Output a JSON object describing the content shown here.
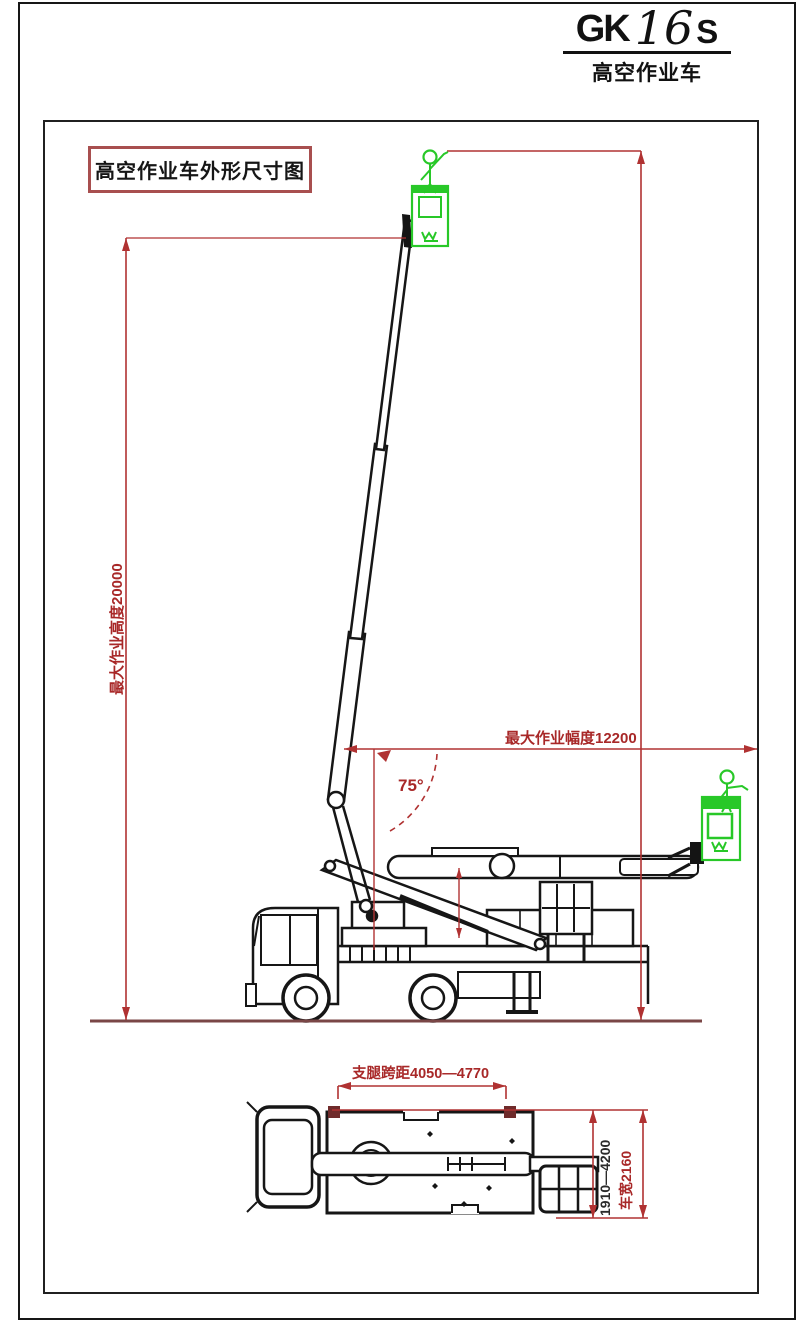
{
  "title_block": {
    "brand": "GK",
    "model": "16",
    "series": "S",
    "subtitle": "高空作业车"
  },
  "drawing_label": "高空作业车外形尺寸图",
  "dimensions": {
    "max_working_height": "最大作业高度20000",
    "max_working_radius": "最大作业幅度12200",
    "boom_angle": "75°",
    "outrigger_span": "支腿跨距4050—4770",
    "outrigger_extension": "1910—4200",
    "vehicle_width": "车宽2160"
  },
  "colors": {
    "dimension_red": "#b03232",
    "dimension_text_red": "#a82828",
    "basket_green": "#28c828",
    "ground_line_brown": "#7a4646",
    "outrigger_marker_dark_red": "#6f2b2b",
    "line_black": "#161616"
  },
  "icons": {
    "operator_top": "person-icon",
    "operator_right": "person-icon",
    "basket_logo": "wing-logo-icon"
  }
}
